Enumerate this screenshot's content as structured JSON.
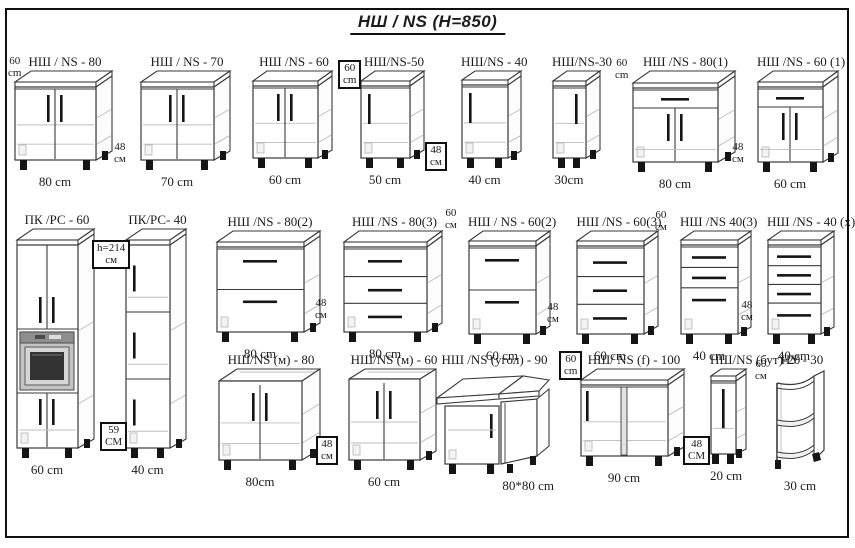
{
  "title": "НШ / NS  (H=850)",
  "colors": {
    "ink": "#3a3a3a",
    "light": "#bdbdbd",
    "leg": "#151515",
    "frame": "#101010",
    "oven_body": "#c4c4c4",
    "oven_strip": "#8e8e8e",
    "oven_window": "#333333"
  },
  "cabinets": [
    {
      "id": "ns-80",
      "label": "НШ / NS - 80",
      "dim": "80 cm",
      "style": "doors2",
      "x": 14,
      "y": 54,
      "fw": 82,
      "bh": 90,
      "depth": 16
    },
    {
      "id": "ns-70",
      "label": "НШ / NS - 70",
      "dim": "70 cm",
      "style": "doors2",
      "x": 140,
      "y": 54,
      "fw": 74,
      "bh": 90,
      "depth": 16
    },
    {
      "id": "ns-60",
      "label": "НШ /NS - 60",
      "dim": "60 cm",
      "style": "doors2",
      "x": 252,
      "y": 54,
      "fw": 66,
      "bh": 88,
      "depth": 14
    },
    {
      "id": "ns-50",
      "label": "НШ/NS-50",
      "dim": "50 cm",
      "style": "door1",
      "x": 360,
      "y": 54,
      "fw": 50,
      "bh": 88,
      "depth": 14,
      "h_side": "left"
    },
    {
      "id": "ns-40",
      "label": "НШ/NS - 40",
      "dim": "40 cm",
      "style": "door1",
      "x": 461,
      "y": 54,
      "fw": 47,
      "bh": 88,
      "depth": 13,
      "h_side": "left"
    },
    {
      "id": "ns-30",
      "label": "НШ/NS-30",
      "dim": "30cm",
      "style": "door1",
      "x": 552,
      "y": 54,
      "fw": 34,
      "bh": 88,
      "depth": 14,
      "h_side": "right"
    },
    {
      "id": "ns-80-1",
      "label": "НШ /NS - 80(1)",
      "dim": "80 cm",
      "style": "drawer_doors2",
      "x": 632,
      "y": 54,
      "fw": 86,
      "bh": 92,
      "depth": 17
    },
    {
      "id": "ns-60-1",
      "label": "НШ /NS - 60 (1)",
      "dim": "60 cm",
      "style": "drawer_doors2",
      "x": 757,
      "y": 54,
      "fw": 66,
      "bh": 92,
      "depth": 15
    },
    {
      "id": "pk-rs-60",
      "label": "ПК /РС - 60",
      "dim": "60 cm",
      "style": "tall_oven",
      "x": 16,
      "y": 212,
      "fw": 62,
      "bh": 220,
      "depth": 16
    },
    {
      "id": "pk-rs-40",
      "label": "ПК/РС- 40",
      "dim": "40 cm",
      "style": "tall_doors3",
      "x": 125,
      "y": 212,
      "fw": 45,
      "bh": 220,
      "depth": 16
    },
    {
      "id": "ns-80-2",
      "label": "НШ /NS - 80(2)",
      "dim": "80 cm",
      "style": "drawers2",
      "x": 216,
      "y": 214,
      "fw": 88,
      "bh": 102,
      "depth": 16
    },
    {
      "id": "ns-80-3",
      "label": "НШ /NS - 80(3)",
      "dim": "80 cm",
      "style": "drawers3",
      "x": 343,
      "y": 214,
      "fw": 84,
      "bh": 102,
      "depth": 15
    },
    {
      "id": "ns-60-2",
      "label": "НШ / NS - 60(2)",
      "dim": "60 cm",
      "style": "drawers2",
      "x": 468,
      "y": 214,
      "fw": 68,
      "bh": 104,
      "depth": 14
    },
    {
      "id": "ns-60-3",
      "label": "НШ /NS - 60(3)",
      "dim": "60 cm",
      "style": "drawers3",
      "x": 576,
      "y": 214,
      "fw": 68,
      "bh": 104,
      "depth": 14
    },
    {
      "id": "ns-40-3",
      "label": "НШ /NS 40(3)",
      "dim": "40 cm",
      "style": "drawers3_tall",
      "x": 680,
      "y": 214,
      "fw": 58,
      "bh": 104,
      "depth": 13
    },
    {
      "id": "ns-40-x",
      "label": "НШ /NS - 40 (х)",
      "dim": "40 cm",
      "style": "drawers4",
      "x": 767,
      "y": 214,
      "fw": 54,
      "bh": 104,
      "depth": 13
    },
    {
      "id": "ns-m-80",
      "label": "НШ/NS (м) - 80",
      "dim": "80cm",
      "style": "sink2",
      "x": 218,
      "y": 352,
      "fw": 84,
      "bh": 92,
      "depth": 18
    },
    {
      "id": "ns-m-60",
      "label": "НШ/NS (м) - 60",
      "dim": "60 cm",
      "style": "sink2",
      "x": 348,
      "y": 352,
      "fw": 72,
      "bh": 92,
      "depth": 16
    },
    {
      "id": "ns-ugol-90",
      "label": "НШ /NS (угол) - 90",
      "dim": "80*80 cm",
      "style": "corner",
      "x": 435,
      "y": 352,
      "fw": 115,
      "bh": 96,
      "depth": 0,
      "dim_align": "right"
    },
    {
      "id": "ns-f-100",
      "label": "НШ/ NS (f) - 100",
      "dim": "90 cm",
      "style": "wide2",
      "x": 580,
      "y": 352,
      "fw": 88,
      "bh": 88,
      "depth": 16
    },
    {
      "id": "ns-but-20",
      "label": "НШ/NS (бут)-20",
      "dim": "20 cm",
      "style": "bottle",
      "x": 710,
      "y": 352,
      "fw": 26,
      "bh": 86,
      "depth": 10
    },
    {
      "id": "nu-30",
      "label": "НУ - 30",
      "dim": "30 cm",
      "style": "open_shelf",
      "x": 774,
      "y": 352,
      "fw": 52,
      "bh": 96,
      "depth": 0
    }
  ],
  "side_labels": [
    {
      "lines": [
        "60",
        "cm"
      ],
      "x": 8,
      "y": 56,
      "boxed": false
    },
    {
      "lines": [
        "48",
        "см"
      ],
      "x": 114,
      "y": 142,
      "boxed": false
    },
    {
      "lines": [
        "60",
        "cm"
      ],
      "x": 338,
      "y": 60,
      "boxed": true
    },
    {
      "lines": [
        "48",
        "см"
      ],
      "x": 425,
      "y": 142,
      "boxed": true
    },
    {
      "lines": [
        "60",
        "cm"
      ],
      "x": 615,
      "y": 58,
      "boxed": false
    },
    {
      "lines": [
        "48",
        "см"
      ],
      "x": 732,
      "y": 142,
      "boxed": false
    },
    {
      "lines": [
        "h=214",
        "см"
      ],
      "x": 92,
      "y": 240,
      "boxed": true
    },
    {
      "lines": [
        "59",
        "СМ"
      ],
      "x": 100,
      "y": 422,
      "boxed": true
    },
    {
      "lines": [
        "48",
        "см"
      ],
      "x": 315,
      "y": 298,
      "boxed": false
    },
    {
      "lines": [
        "60",
        "см"
      ],
      "x": 445,
      "y": 208,
      "boxed": false
    },
    {
      "lines": [
        "48",
        "см"
      ],
      "x": 547,
      "y": 302,
      "boxed": false
    },
    {
      "lines": [
        "60",
        "см"
      ],
      "x": 655,
      "y": 210,
      "boxed": false
    },
    {
      "lines": [
        "48",
        "см"
      ],
      "x": 741,
      "y": 300,
      "boxed": false
    },
    {
      "lines": [
        "48",
        "см"
      ],
      "x": 316,
      "y": 436,
      "boxed": true
    },
    {
      "lines": [
        "60",
        "cm"
      ],
      "x": 559,
      "y": 351,
      "boxed": true
    },
    {
      "lines": [
        "48",
        "СМ"
      ],
      "x": 683,
      "y": 436,
      "boxed": true
    },
    {
      "lines": [
        "60",
        "см"
      ],
      "x": 755,
      "y": 359,
      "boxed": false
    }
  ]
}
